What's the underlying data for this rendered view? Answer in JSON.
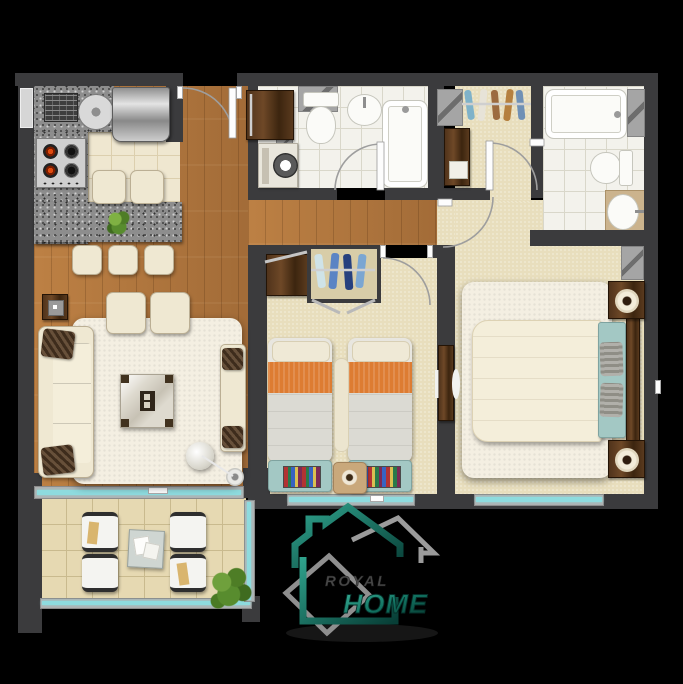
{
  "logo": {
    "top": "ROYAL",
    "bottom": "HOME"
  },
  "colors": {
    "background": "#000000",
    "wall": "#3b3b3d",
    "wood_floor": "#b5783e",
    "kitchen_tile": "#efe7d0",
    "bath_tile": "#f3f2ec",
    "carpet": "#e8debd",
    "balcony_tile": "#e6d9b2",
    "glass": "#8edbde",
    "accent_orange": "#dd7c32",
    "furniture_cream": "#efe8d2",
    "furniture_teal": "#a3c8c4",
    "dark_wood": "#4a2f18",
    "white_fixture": "#fbfbf8",
    "logo_teal_light": "#2fa28c",
    "logo_teal_dark": "#083f37",
    "logo_gray": "#9b9b9b"
  }
}
